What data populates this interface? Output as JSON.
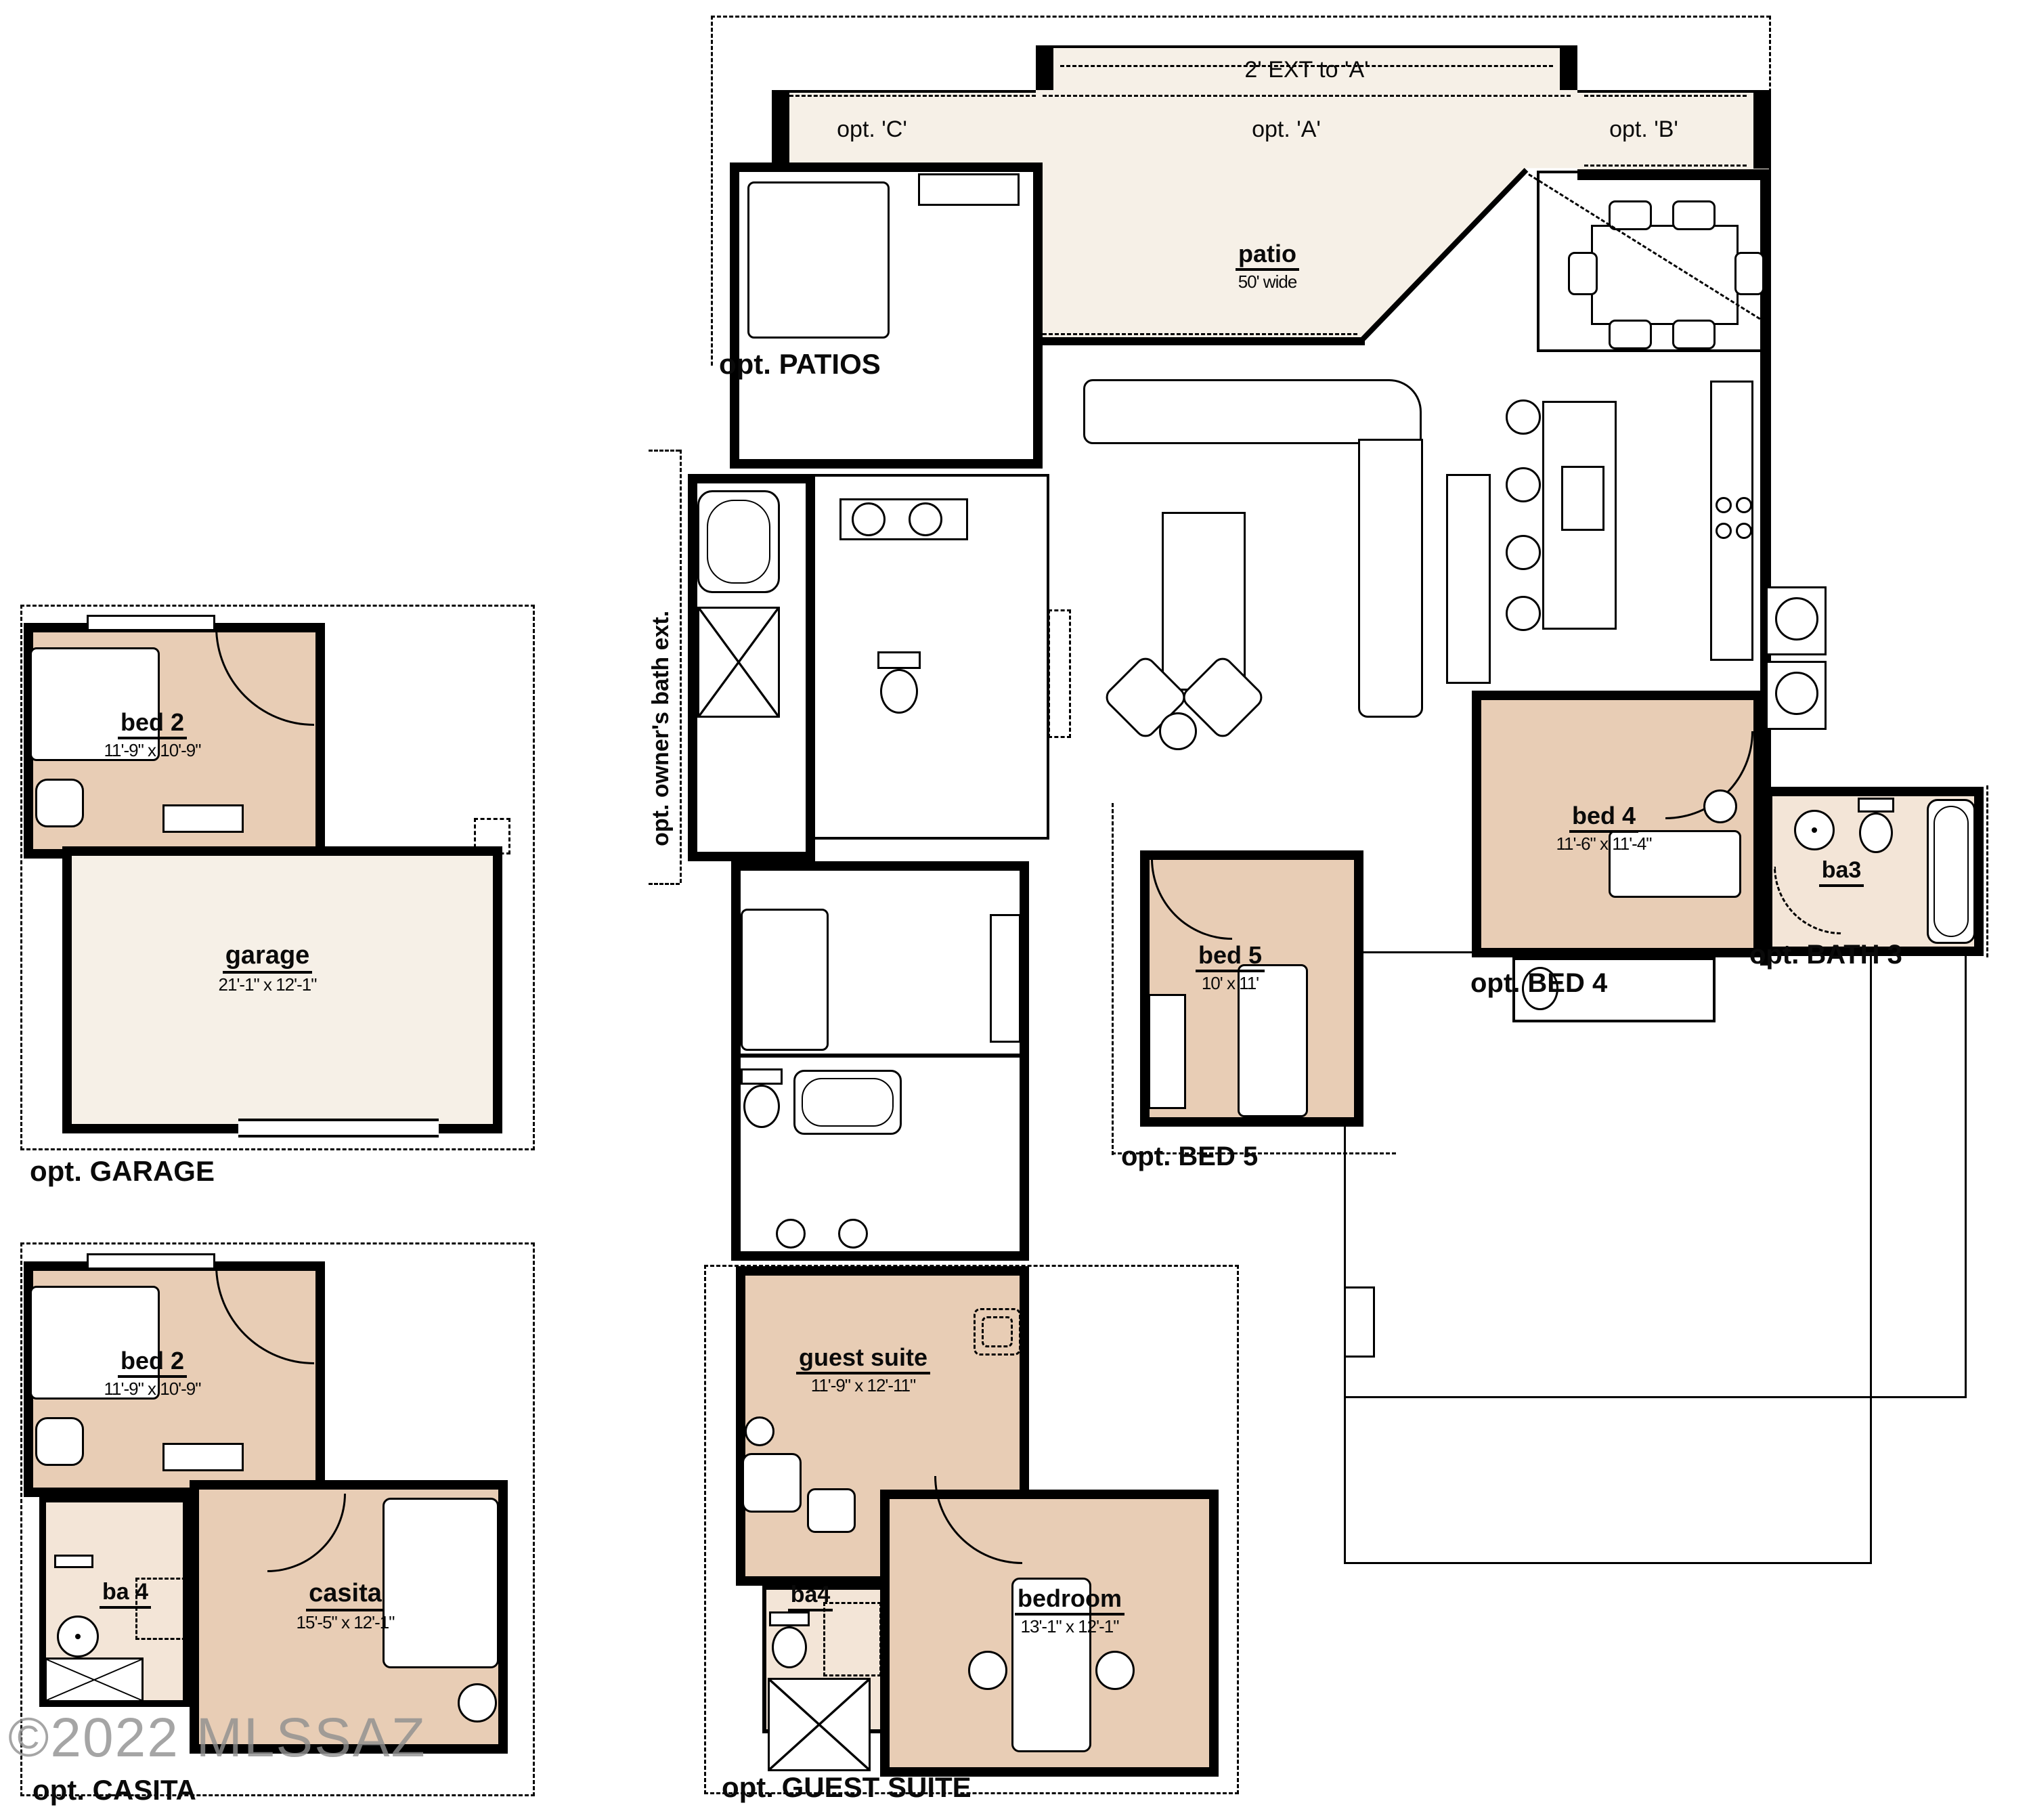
{
  "plan": {
    "watermark": "©2022 MLSSAZ",
    "colors": {
      "wall": "#000000",
      "room_tan": "#e8cdb5",
      "room_light": "#f3e5d7",
      "patio_cream": "#f6f0e7",
      "background": "#ffffff",
      "watermark_gray": "#8f8f8f"
    },
    "patio_options": {
      "ext": "2' EXT to 'A'",
      "c": "opt. 'C'",
      "a": "opt. 'A'",
      "b": "opt. 'B'",
      "patios_label": "opt. PATIOS"
    },
    "patio": {
      "name": "patio",
      "size": "50' wide"
    },
    "owners_bath_ext_label": "opt. owner's bath ext.",
    "garage_block": {
      "label": "opt. GARAGE",
      "bed2": {
        "name": "bed 2",
        "dims": "11'-9\" x 10'-9\""
      },
      "garage": {
        "name": "garage",
        "dims": "21'-1\" x 12'-1\""
      }
    },
    "casita_block": {
      "label": "opt. CASITA",
      "bed2": {
        "name": "bed 2",
        "dims": "11'-9\" x 10'-9\""
      },
      "ba4": {
        "name": "ba 4"
      },
      "casita": {
        "name": "casita",
        "dims": "15'-5\" x 12'-1\""
      }
    },
    "guest_block": {
      "label": "opt. GUEST SUITE",
      "guest_suite": {
        "name": "guest suite",
        "dims": "11'-9\" x 12'-11\""
      },
      "ba4": {
        "name": "ba4"
      },
      "bedroom": {
        "name": "bedroom",
        "dims": "13'-1\" x 12'-1\""
      }
    },
    "bed5_block": {
      "label": "opt. BED 5",
      "bed5": {
        "name": "bed 5",
        "dims": "10' x 11'"
      }
    },
    "bed4_block": {
      "label": "opt. BED 4",
      "bed4": {
        "name": "bed 4",
        "dims": "11'-6\" x 11'-4\""
      }
    },
    "bath3_block": {
      "label": "opt. BATH 3",
      "ba3": {
        "name": "ba3"
      }
    }
  }
}
